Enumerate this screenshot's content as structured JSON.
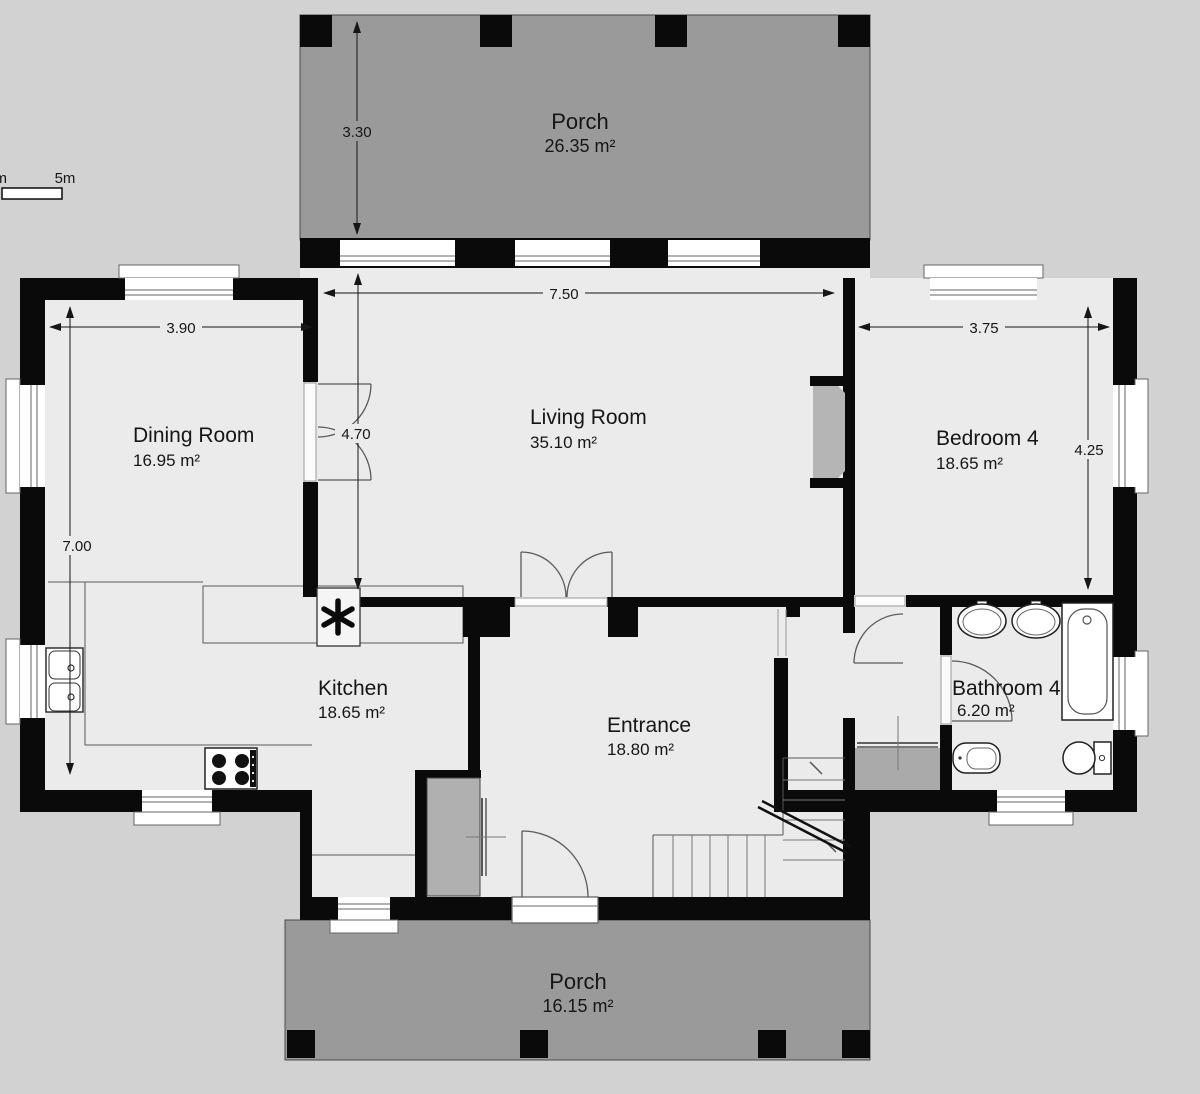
{
  "scale_bar": {
    "end_label": "5m",
    "start_label": "m"
  },
  "rooms": {
    "porch_top": {
      "name": "Porch",
      "area": "26.35 m²"
    },
    "dining": {
      "name": "Dining Room",
      "area": "16.95 m²"
    },
    "living": {
      "name": "Living Room",
      "area": "35.10 m²"
    },
    "bedroom4": {
      "name": "Bedroom 4",
      "area": "18.65 m²"
    },
    "kitchen": {
      "name": "Kitchen",
      "area": "18.65 m²"
    },
    "entrance": {
      "name": "Entrance",
      "area": "18.80 m²"
    },
    "bathroom4": {
      "name": "Bathroom 4",
      "area": "6.20 m²"
    },
    "porch_bottom": {
      "name": "Porch",
      "area": "16.15 m²"
    }
  },
  "dimensions": {
    "porch_depth": "3.30",
    "living_width": "7.50",
    "dining_width": "3.90",
    "living_depth": "4.70",
    "left_depth": "7.00",
    "bedroom_width": "3.75",
    "bedroom_depth": "4.25"
  },
  "colors": {
    "background": "#d2d2d2",
    "floor": "#ebebeb",
    "porch": "#9a9a9a",
    "wall": "#0a0a0a",
    "fixture_gray": "#b5b5b5"
  }
}
